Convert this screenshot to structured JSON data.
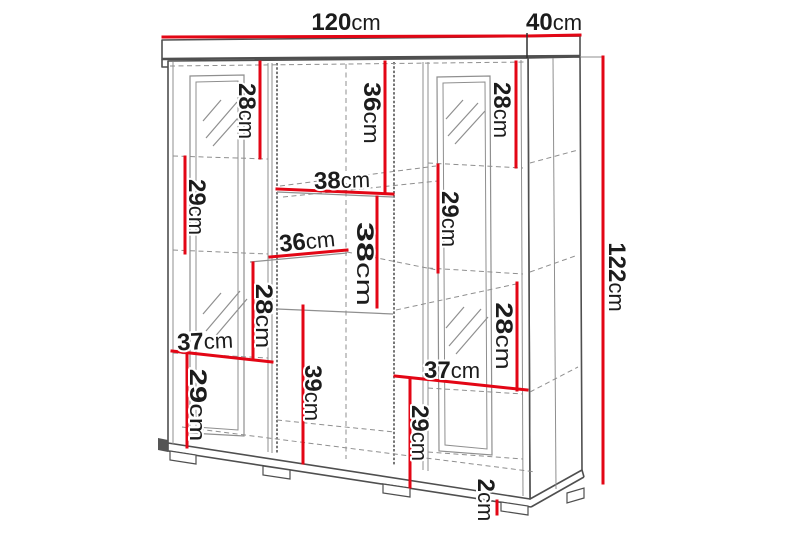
{
  "colors": {
    "dimension_red": "#e30615",
    "outline_gray": "#4f4f4f",
    "detail_gray": "#8f8f8f",
    "label_black": "#1c1c1c",
    "background": "#ffffff"
  },
  "dimensions": {
    "width_top": {
      "value": "120",
      "unit": "cm"
    },
    "depth_top": {
      "value": "40",
      "unit": "cm"
    },
    "height_right": {
      "value": "122",
      "unit": "cm"
    },
    "upper_left_28": {
      "value": "28",
      "unit": "cm"
    },
    "upper_mid_36": {
      "value": "36",
      "unit": "cm"
    },
    "upper_right_28": {
      "value": "28",
      "unit": "cm"
    },
    "left_29": {
      "value": "29",
      "unit": "cm"
    },
    "mid_width_38": {
      "value": "38",
      "unit": "cm"
    },
    "right_mid_29": {
      "value": "29",
      "unit": "cm"
    },
    "mid_depth_36": {
      "value": "36",
      "unit": "cm"
    },
    "mid_height_38": {
      "value": "38",
      "unit": "cm"
    },
    "left_mid_28": {
      "value": "28",
      "unit": "cm"
    },
    "left_width_37": {
      "value": "37",
      "unit": "cm"
    },
    "left_bottom_29": {
      "value": "29",
      "unit": "cm"
    },
    "mid_bottom_39": {
      "value": "39",
      "unit": "cm"
    },
    "right_lower_28": {
      "value": "28",
      "unit": "cm"
    },
    "right_width_37": {
      "value": "37",
      "unit": "cm"
    },
    "right_bottom_29": {
      "value": "29",
      "unit": "cm"
    },
    "foot_height_2": {
      "value": "2",
      "unit": "cm"
    }
  }
}
